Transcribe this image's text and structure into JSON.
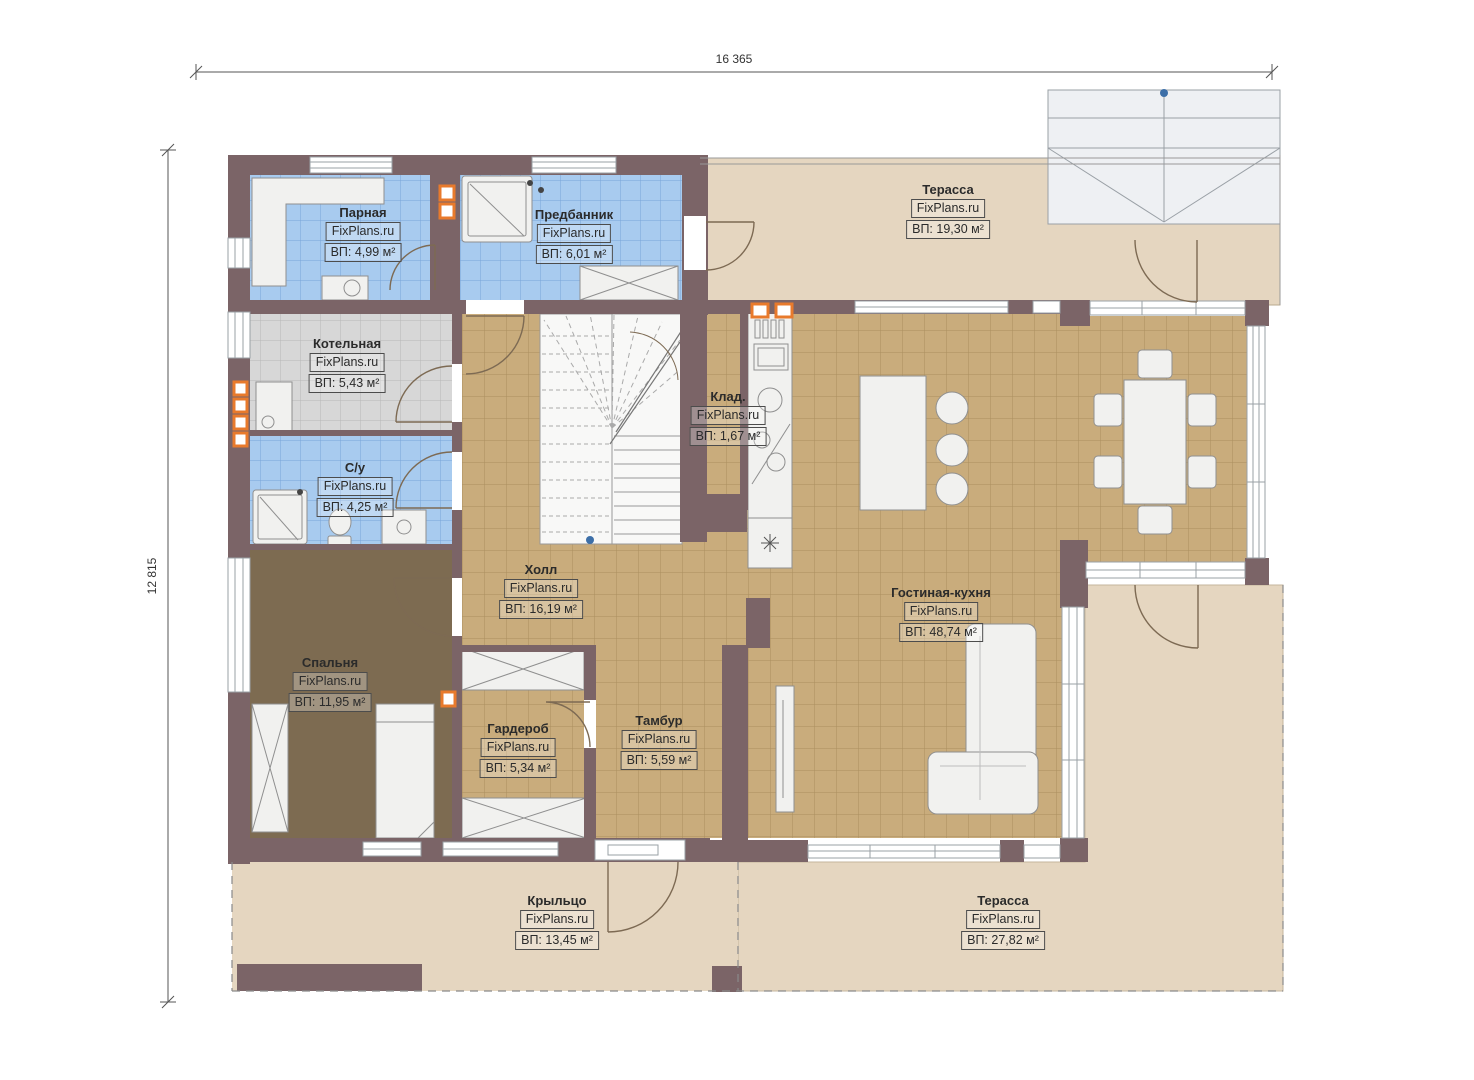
{
  "plan": {
    "watermark": "FixPlans.ru",
    "dim_width": "16 365",
    "dim_height": "12 815",
    "rooms": [
      {
        "id": "parnaya",
        "name": "Парная",
        "area": "ВП: 4,99 м²"
      },
      {
        "id": "predbannik",
        "name": "Предбанник",
        "area": "ВП: 6,01 м²"
      },
      {
        "id": "terrace-top",
        "name": "Терасса",
        "area": "ВП: 19,30 м²"
      },
      {
        "id": "kotelnaya",
        "name": "Котельная",
        "area": "ВП: 5,43 м²"
      },
      {
        "id": "klad",
        "name": "Клад.",
        "area": "ВП: 1,67 м²"
      },
      {
        "id": "su",
        "name": "С/у",
        "area": "ВП: 4,25 м²"
      },
      {
        "id": "holl",
        "name": "Холл",
        "area": "ВП: 16,19 м²"
      },
      {
        "id": "gostinaya-kuhnya",
        "name": "Гостиная-кухня",
        "area": "ВП: 48,74 м²"
      },
      {
        "id": "spalnya",
        "name": "Спальня",
        "area": "ВП: 11,95 м²"
      },
      {
        "id": "garderob",
        "name": "Гардероб",
        "area": "ВП: 5,34 м²"
      },
      {
        "id": "tambur",
        "name": "Тамбур",
        "area": "ВП: 5,59 м²"
      },
      {
        "id": "kryltso",
        "name": "Крыльцо",
        "area": "ВП: 13,45 м²"
      },
      {
        "id": "terrace-bottom",
        "name": "Терасса",
        "area": "ВП: 27,82 м²"
      }
    ],
    "colors": {
      "wall": "#7b6467",
      "tile_tan": "#c9ac7c",
      "tile_blue": "#a8cbef",
      "tile_gray": "#d7d7d7",
      "terrace": "#e5d6c0",
      "bedroom_floor": "#7d6b51",
      "vent_orange": "#e87a2c",
      "marker_blue": "#3d6fa8"
    }
  }
}
